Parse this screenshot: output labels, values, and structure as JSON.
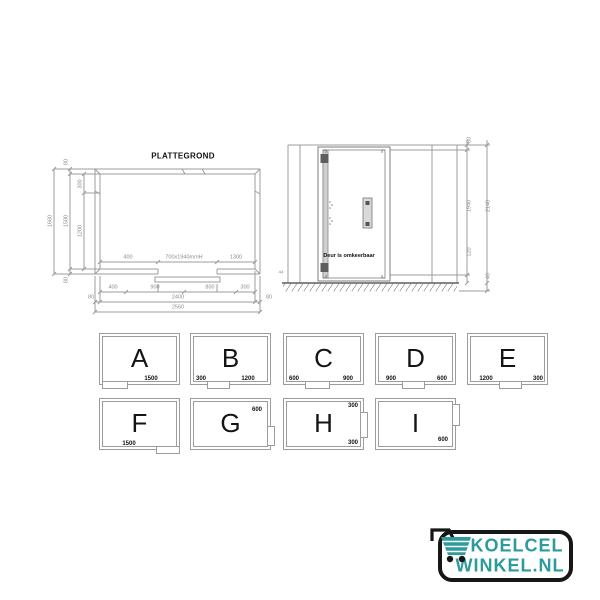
{
  "plan": {
    "title": "PLATTEGROND",
    "left": {
      "overall": "1660",
      "wall_top": "80",
      "inner": "1500",
      "wall_bottom": "80",
      "seg_top": "300",
      "seg_bottom": "1200"
    },
    "bottom": {
      "row1": [
        "400",
        "700x1940mmH",
        "1300"
      ],
      "row2": [
        "400",
        "900",
        "800",
        "300"
      ],
      "row3": [
        "80",
        "2400",
        "80"
      ],
      "row4": "2560"
    }
  },
  "elevation": {
    "door_note": "Deur is omkeerbaar",
    "ref_mark": "44",
    "right": {
      "top": "80",
      "door": "1940",
      "overall": "2140",
      "sill": "120",
      "floor": "40"
    }
  },
  "options": [
    {
      "letter": "A",
      "dims": [
        "1500"
      ]
    },
    {
      "letter": "B",
      "dims": [
        "300",
        "1200"
      ]
    },
    {
      "letter": "C",
      "dims": [
        "600",
        "900"
      ]
    },
    {
      "letter": "D",
      "dims": [
        "900",
        "600"
      ]
    },
    {
      "letter": "E",
      "dims": [
        "1200",
        "300"
      ]
    },
    {
      "letter": "F",
      "dims": [
        "1500"
      ]
    },
    {
      "letter": "G",
      "dims": [
        "600"
      ]
    },
    {
      "letter": "H",
      "dims": [
        "300",
        "300"
      ]
    },
    {
      "letter": "I",
      "dims": [
        "600"
      ]
    }
  ],
  "logo": {
    "line1": "KOELCEL",
    "line2": "WINKEL.NL",
    "accent_color": "#2d9b9b"
  }
}
